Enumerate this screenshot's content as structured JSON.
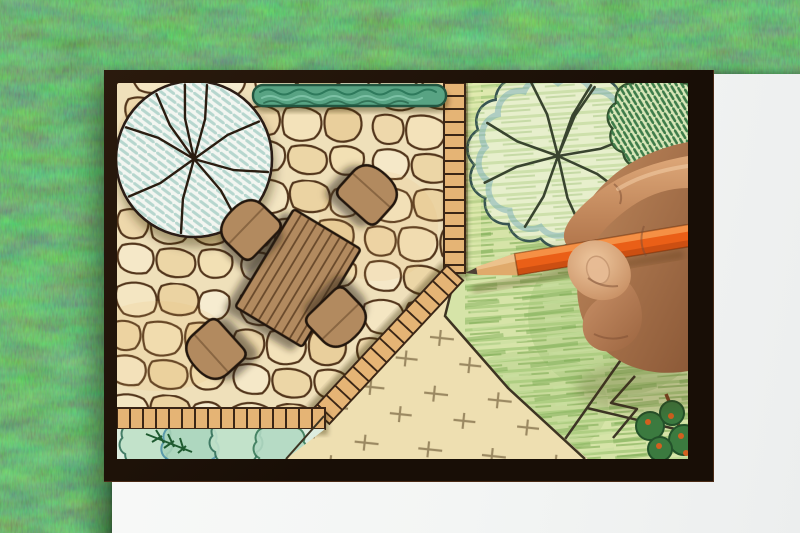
{
  "meta": {
    "type": "photograph",
    "description": "Overhead photo of a landscape architect's garden plan drawn in colored pencil on white paper lying on green grass, while a hand draws on it with an orange colored pencil.",
    "visible_text": "none"
  },
  "palette": {
    "grass": "#3f7238",
    "paper": "#f6f7f7",
    "plan_border": "#1f1309",
    "flagstone": "#f1e3bf",
    "stone_outline": "#4e3218",
    "paver_edging": "#e5b474",
    "hedge_green": "#58a383",
    "tree_hatch_teal": "#b6d6ce",
    "lawn_green": "#d6e4a8",
    "lawn_stroke": "#8ab45f",
    "gravel_sand": "#f2e5bd",
    "wood_furniture": "#b28a5e",
    "pencil_orange": "#ea5f17",
    "skin_tone": "#c08a5e"
  },
  "scene": {
    "background": "artificial grass lawn",
    "paper": "white drawing sheet",
    "border": "dark plan border frame",
    "plan": {
      "patio": "flagstone patio",
      "hedge": "clipped hedge row",
      "tree_left": "tree canopy symbol with radial branches and teal hatching",
      "tree_right": "scalloped tree canopy symbol with radial branches",
      "shrub_right": "green hatched shrub symbol",
      "lawn": "green colored-pencil lawn",
      "gravel": "gravel area with cross tick marks",
      "shrub_bed": "shrub planting bed with conifer",
      "edging": "brick paver edging bands",
      "paths": "garden path lines",
      "corner_planting": "corner planting with orange blooms"
    },
    "furniture": {
      "table": "rectangular plank dining table",
      "chairs": "four round-back chairs"
    },
    "hand": "right hand holding a pencil",
    "pencil": "orange colored pencil"
  }
}
